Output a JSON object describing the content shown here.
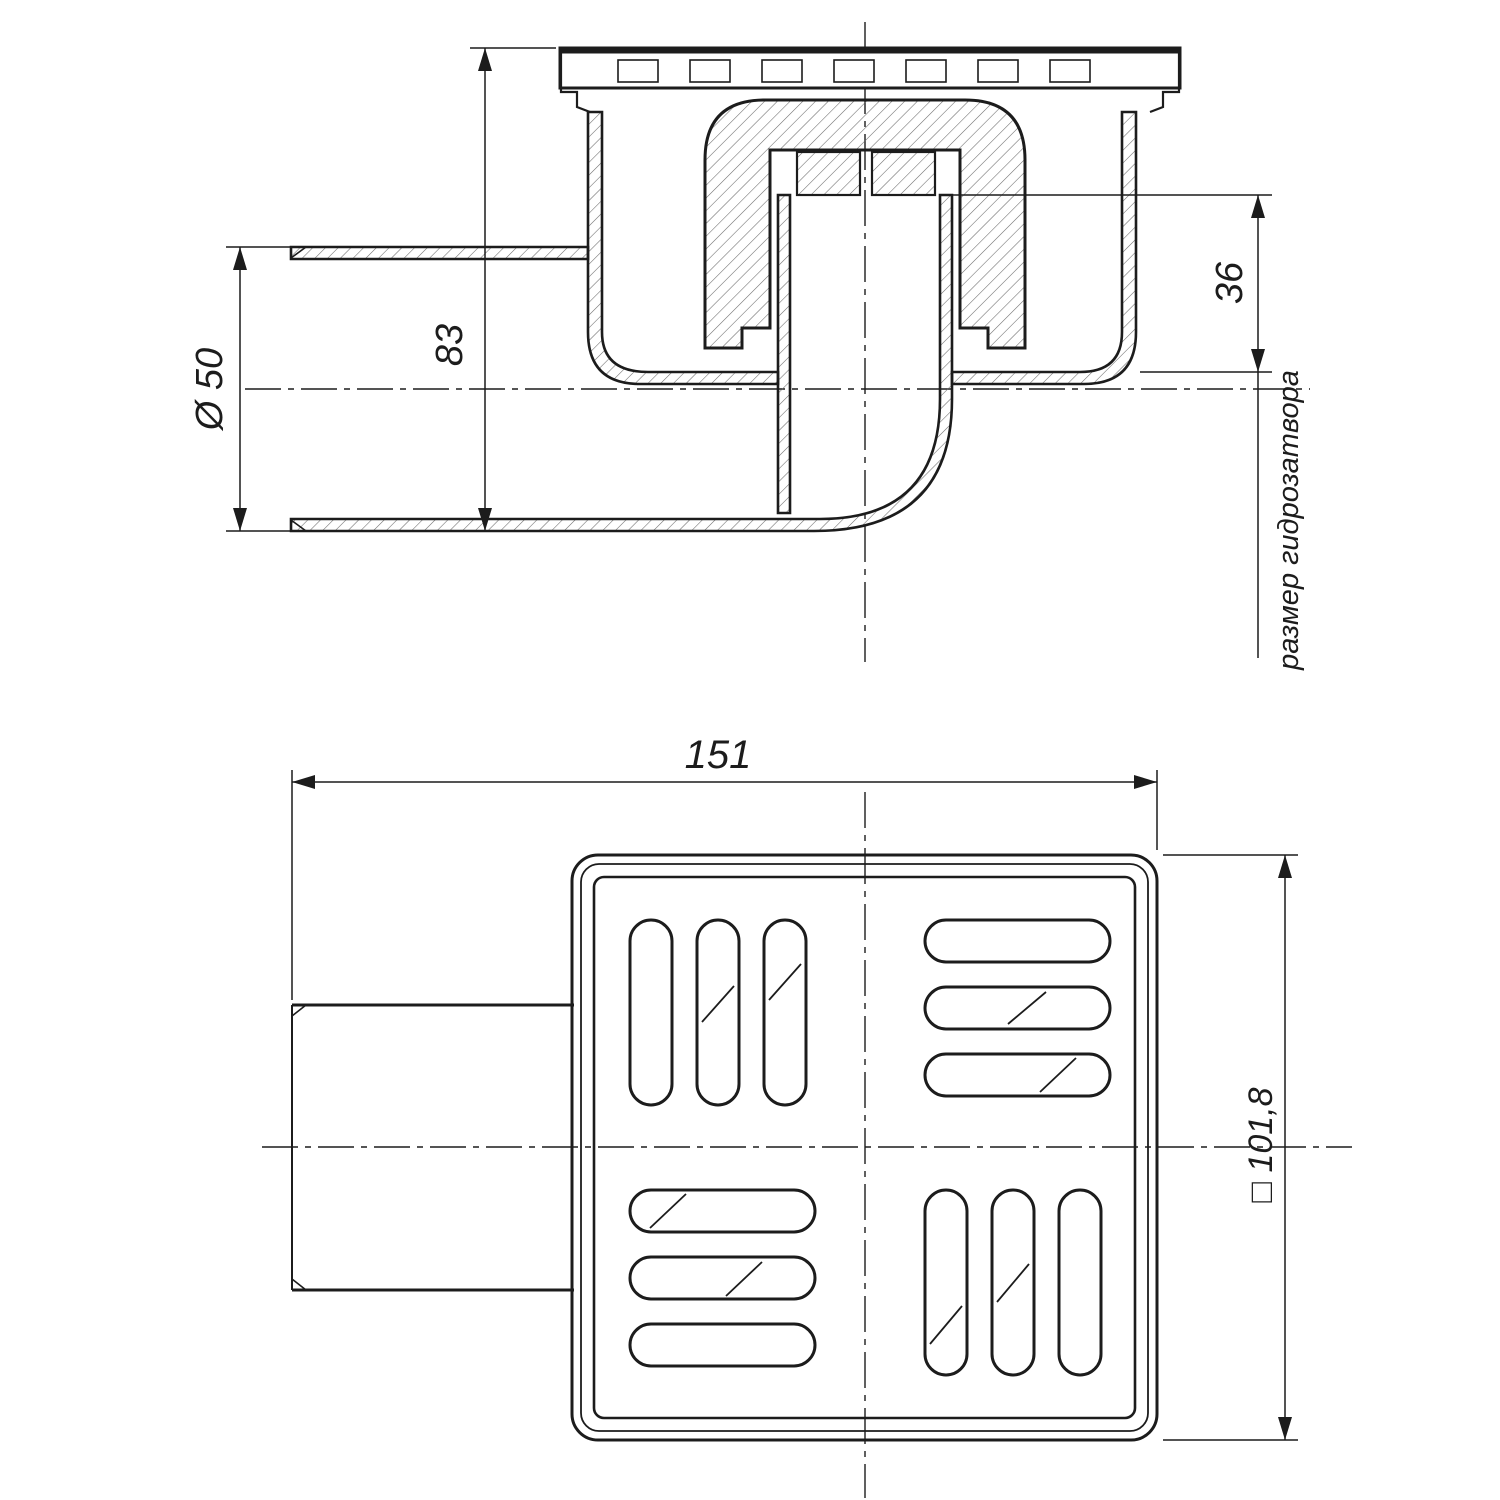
{
  "colors": {
    "background": "#ffffff",
    "line": "#1c1c1c"
  },
  "section_view": {
    "dim_pipe_diameter": "Ø 50",
    "dim_height": "83",
    "dim_water_seal": "36",
    "water_seal_caption": "размер гидрозатвора"
  },
  "plan_view": {
    "dim_width": "151",
    "dim_square": "□ 101,8"
  }
}
